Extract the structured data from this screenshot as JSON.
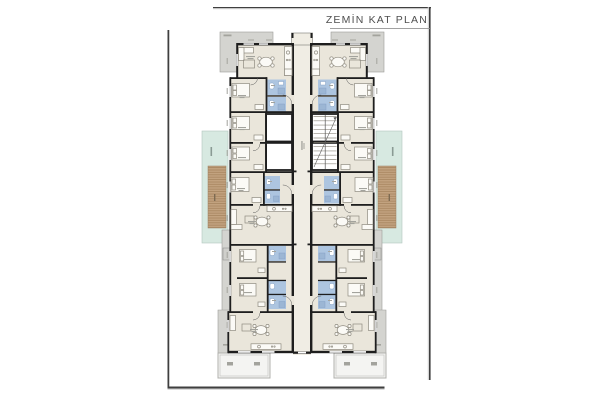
{
  "title": "ZEMİN KAT PLAN",
  "drawing": {
    "kind": "architectural-floor-plan",
    "floor": "ground-floor",
    "blocks": 2,
    "symmetry": "mirrored-left-right"
  },
  "colors": {
    "paper": "#ffffff",
    "title": "#4f4f4f",
    "frame": "#3f3f3f",
    "frame-shadow": "#cccccc",
    "wall": "#1e1e1e",
    "room": "#eae6db",
    "corridor": "#f0ede4",
    "bathroom": "#adc5e0",
    "shower": "#9cb6d4",
    "fixture-line": "#7f9cc0",
    "terrace": "#d4d4d0",
    "terrace-border": "#9c9c98",
    "garden": "#d7e9e1",
    "garden-border": "#b2c6be",
    "deck": "#c2a27f",
    "deck-stripe": "#a78660",
    "furniture-line": "#8f8b80",
    "furniture-fill": "#fbfaf6",
    "door": "#5a5a5a",
    "window": "#9c9c9c",
    "smudge": "#a3a39d"
  }
}
